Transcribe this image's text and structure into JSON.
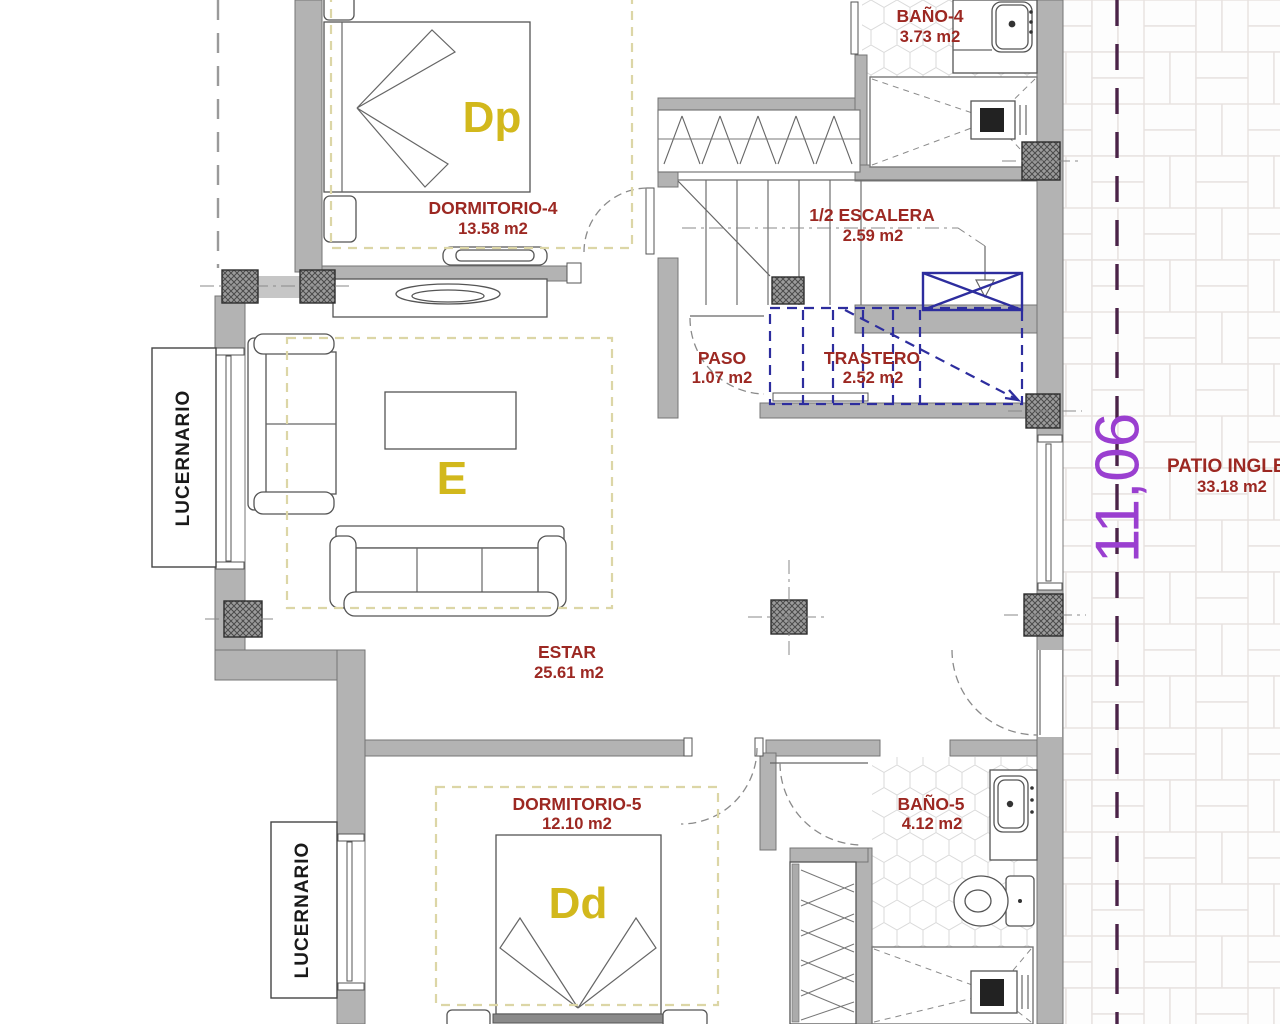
{
  "rooms": {
    "dormitorio4": {
      "name": "DORMITORIO-4",
      "area": "13.58 m2",
      "tag": "Dp"
    },
    "bano4": {
      "name": "BAÑO-4",
      "area": "3.73 m2"
    },
    "escalera": {
      "name": "1/2 ESCALERA",
      "area": "2.59 m2"
    },
    "paso": {
      "name": "PASO",
      "area": "1.07 m2"
    },
    "trastero": {
      "name": "TRASTERO",
      "area": "2.52 m2"
    },
    "estar": {
      "name": "ESTAR",
      "area": "25.61 m2",
      "tag": "E"
    },
    "dormitorio5": {
      "name": "DORMITORIO-5",
      "area": "12.10 m2",
      "tag": "Dd"
    },
    "bano5": {
      "name": "BAÑO-5",
      "area": "4.12 m2"
    },
    "patio": {
      "name": "PATIO INGLE",
      "area": "33.18 m2"
    }
  },
  "labels": {
    "lucernario_top": "LUCERNARIO",
    "lucernario_bottom": "LUCERNARIO"
  },
  "dimensions": {
    "patio_width": "11,06"
  },
  "colors": {
    "wall_gray": "#b3b3b3",
    "room_label_red": "#9c2822",
    "tag_yellow": "#d2b81c",
    "surface_outline_khaki": "#dcd6a6",
    "trastero_blue": "#2d2d9e",
    "dimension_purple": "#9a3fd0",
    "dimension_line_purple": "#4a2348"
  }
}
